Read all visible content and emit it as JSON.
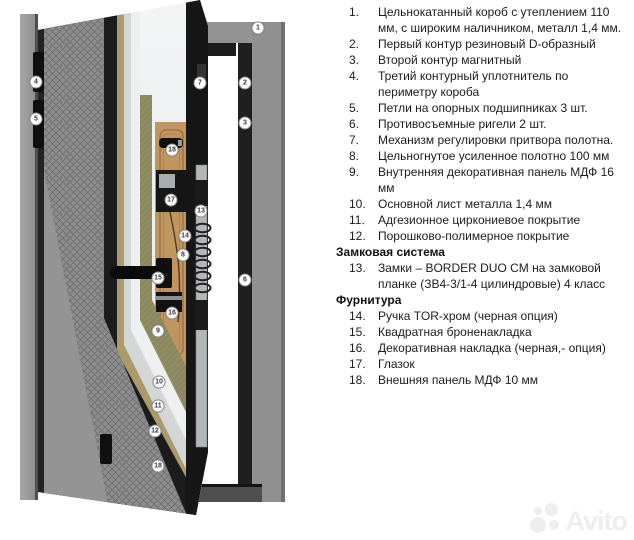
{
  "legend": {
    "groups": [
      {
        "header": "",
        "items": [
          {
            "num": "1.",
            "text": "Цельнокатанный короб с утеплением 110 мм, с широким наличником, металл 1,4 мм."
          },
          {
            "num": "2.",
            "text": "Первый контур резиновый D-образный"
          },
          {
            "num": "3.",
            "text": "Второй контур магнитный"
          },
          {
            "num": "4.",
            "text": "Третий контурный уплотнитель по периметру короба"
          },
          {
            "num": "5.",
            "text": "Петли на опорных подшипниках 3 шт."
          },
          {
            "num": "6.",
            "text": "Противосъемные ригели 2 шт."
          },
          {
            "num": "7.",
            "text": "Механизм регулировки притвора полотна."
          },
          {
            "num": "8.",
            "text": "Цельногнутое усиленное полотно 100 мм"
          },
          {
            "num": "9.",
            "text": "Внутренняя декоративная панель МДФ 16 мм"
          },
          {
            "num": "10.",
            "text": "Основной лист металла 1,4 мм"
          },
          {
            "num": "11.",
            "text": "Адгезионное циркониевое покрытие"
          },
          {
            "num": "12.",
            "text": "Порошково-полимерное покрытие"
          }
        ]
      },
      {
        "header": "Замковая система",
        "items": [
          {
            "num": "13.",
            "text": "Замки – BORDER DUO CM на замковой планке (ЗВ4-3/1-4 цилиндровые) 4 класс"
          }
        ]
      },
      {
        "header": "Фурнитура",
        "items": [
          {
            "num": "14.",
            "text": "Ручка TOR-хром (черная опция)"
          },
          {
            "num": "15.",
            "text": "Квадратная броненакладка"
          },
          {
            "num": "16.",
            "text": "Декоративная накладка (черная,- опция)"
          },
          {
            "num": "17.",
            "text": "Глазок"
          },
          {
            "num": "18.",
            "text": "Внешняя панель МДФ 10 мм"
          }
        ]
      }
    ]
  },
  "diagram": {
    "badges": [
      {
        "n": "1",
        "x": 258,
        "y": 28
      },
      {
        "n": "2",
        "x": 245,
        "y": 83
      },
      {
        "n": "3",
        "x": 245,
        "y": 123
      },
      {
        "n": "4",
        "x": 36,
        "y": 82
      },
      {
        "n": "5",
        "x": 36,
        "y": 119
      },
      {
        "n": "6",
        "x": 245,
        "y": 280
      },
      {
        "n": "7",
        "x": 200,
        "y": 83
      },
      {
        "n": "8",
        "x": 183,
        "y": 255
      },
      {
        "n": "9",
        "x": 158,
        "y": 331
      },
      {
        "n": "10",
        "x": 159,
        "y": 382
      },
      {
        "n": "11",
        "x": 158,
        "y": 406
      },
      {
        "n": "12",
        "x": 155,
        "y": 431
      },
      {
        "n": "13",
        "x": 201,
        "y": 211
      },
      {
        "n": "14",
        "x": 185,
        "y": 236
      },
      {
        "n": "15",
        "x": 158,
        "y": 278
      },
      {
        "n": "16",
        "x": 172,
        "y": 313
      },
      {
        "n": "17",
        "x": 171,
        "y": 200
      },
      {
        "n": "18",
        "x": 172,
        "y": 150
      },
      {
        "n": "18",
        "x": 158,
        "y": 466
      }
    ],
    "colors": {
      "outer_panel": "#8d8d8d",
      "steel_leaf": "#1c1c1c",
      "zirconium_layer": "#ab9a6c",
      "steel_sheet": "#d4d6d6",
      "inner_panel": "#eef0f0",
      "insulation": "#8f8c63",
      "wood_panel": "#c0955f",
      "frame": "#909090",
      "lock_rail": "#b4b7b8"
    }
  },
  "watermark": {
    "text": "Avito"
  }
}
